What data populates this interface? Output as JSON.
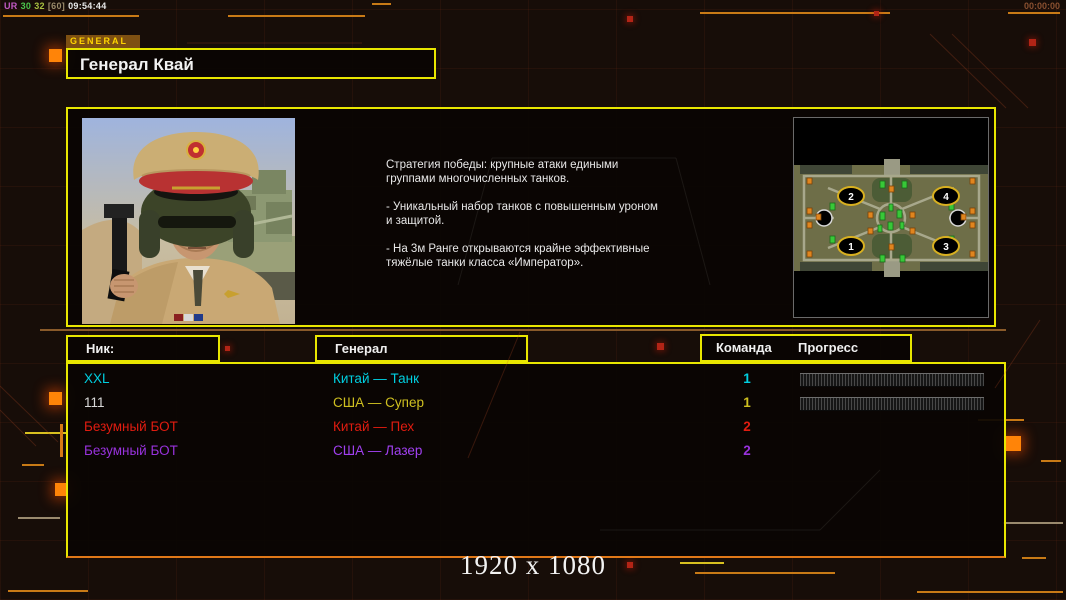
{
  "overlay": {
    "stats": [
      {
        "text": "UR",
        "color": "#c45ac4"
      },
      {
        "text": "30",
        "color": "#4cc44c"
      },
      {
        "text": "32",
        "color": "#a8c040"
      },
      {
        "text": "[60]",
        "color": "#9a8a6a"
      },
      {
        "text": "09:54:44",
        "color": "#e8e8e8"
      }
    ],
    "timer": "00:00:00",
    "resolution": "1920 x 1080"
  },
  "header": {
    "tab_label": "GENERAL",
    "title": "Генерал Квай"
  },
  "info": {
    "description": [
      "Стратегия победы: крупные атаки едиными\nгруппами многочисленных танков.",
      "- Уникальный набор танков с повышенным уроном\nи защитой.",
      "- На 3м Ранге открываются крайне эффективные\nтяжёлые танки класса «Император»."
    ],
    "minimap": {
      "start_positions": [
        "1",
        "2",
        "3",
        "4"
      ]
    }
  },
  "table": {
    "headers": {
      "nick": "Ник:",
      "general": "Генерал",
      "team": "Команда",
      "progress": "Прогресс"
    },
    "rows": [
      {
        "nick": "XXL",
        "nick_color": "#00cfe0",
        "general": "Китай — Танк",
        "general_color": "#00cfe0",
        "team": "1",
        "team_color": "#00cfe0",
        "has_progress": true
      },
      {
        "nick": "111",
        "nick_color": "#d8d8d8",
        "general": "США — Супер",
        "general_color": "#cfc020",
        "team": "1",
        "team_color": "#cfc020",
        "has_progress": true
      },
      {
        "nick": "Безумный БОТ",
        "nick_color": "#e01c10",
        "general": "Китай — Пех",
        "general_color": "#e01c10",
        "team": "2",
        "team_color": "#e01c10",
        "has_progress": false
      },
      {
        "nick": "Безумный БОТ",
        "nick_color": "#9832dc",
        "general": "США — Лазер",
        "general_color": "#a040f0",
        "team": "2",
        "team_color": "#9832dc",
        "has_progress": false
      }
    ]
  },
  "colors": {
    "accent_yellow": "#e8e600",
    "accent_orange": "#e07818",
    "background": "#170d08"
  }
}
